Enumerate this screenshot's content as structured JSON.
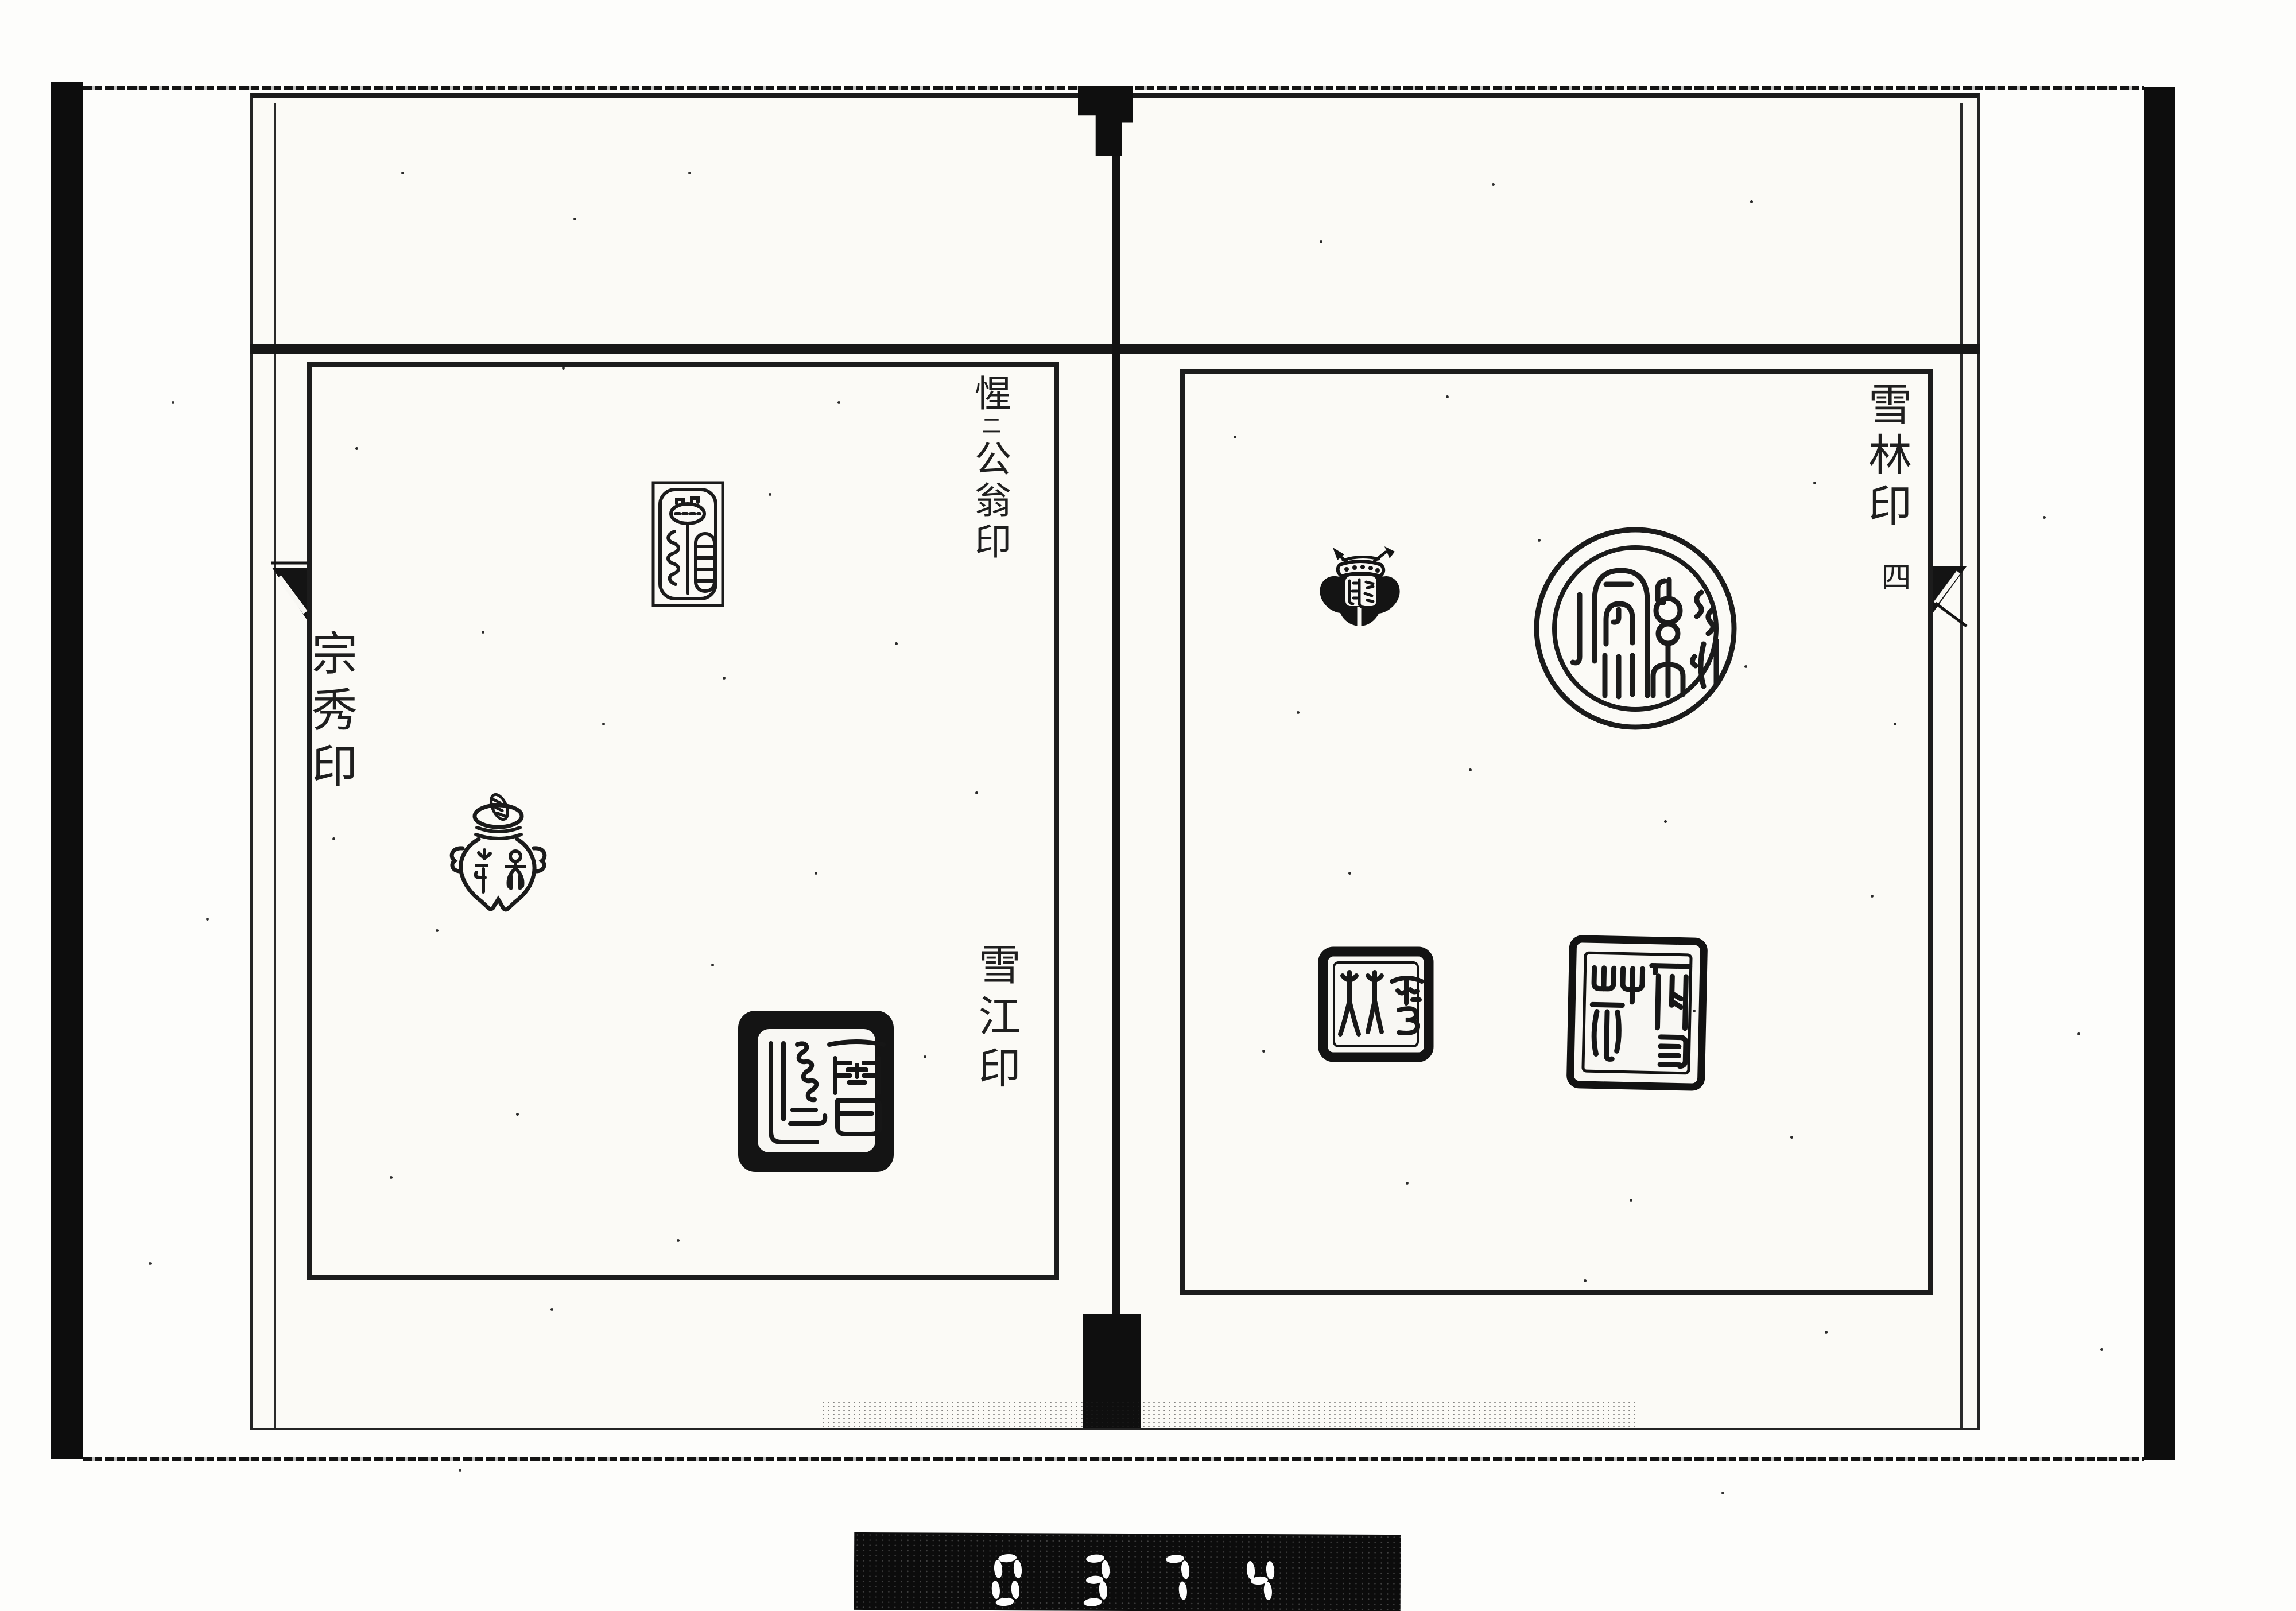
{
  "left_page": {
    "labels": {
      "top_right_prefix": "惺",
      "top_right_iteration_mark": "二",
      "top_right_suffix": "公翁印",
      "bottom_right": "雪江印",
      "left": "宗秀印"
    },
    "seals": [
      {
        "name": "rectangular-outline-seal",
        "shape": "rectangle with rounded inner frame, seal-script glyph"
      },
      {
        "name": "vase-shaped-seal",
        "shape": "lidded urn with side handles, seal-script glyphs inside"
      },
      {
        "name": "black-square-seal",
        "shape": "thick black rounded square, white field with seal-script 雪 glyphs"
      }
    ]
  },
  "right_page": {
    "labels": {
      "top_right": "雪林印",
      "page_number": "四"
    },
    "seals": [
      {
        "name": "butterfly-shaped-seal",
        "shape": "black butterfly silhouette with white banded head and dotted markings"
      },
      {
        "name": "round-seal",
        "shape": "double-circle border, seal-script glyphs"
      },
      {
        "name": "square-seal-small",
        "shape": "thick black square border, seal-script 林雪"
      },
      {
        "name": "square-seal-large",
        "shape": "double-line square border, seal-script 雪林"
      }
    ]
  },
  "film_counter": {
    "digits": "0374"
  },
  "colors": {
    "ink": "#1c1c1c",
    "paper": "#fbfaf6",
    "counter_background": "#0c0c0c",
    "counter_digit": "#fdfdfd"
  }
}
